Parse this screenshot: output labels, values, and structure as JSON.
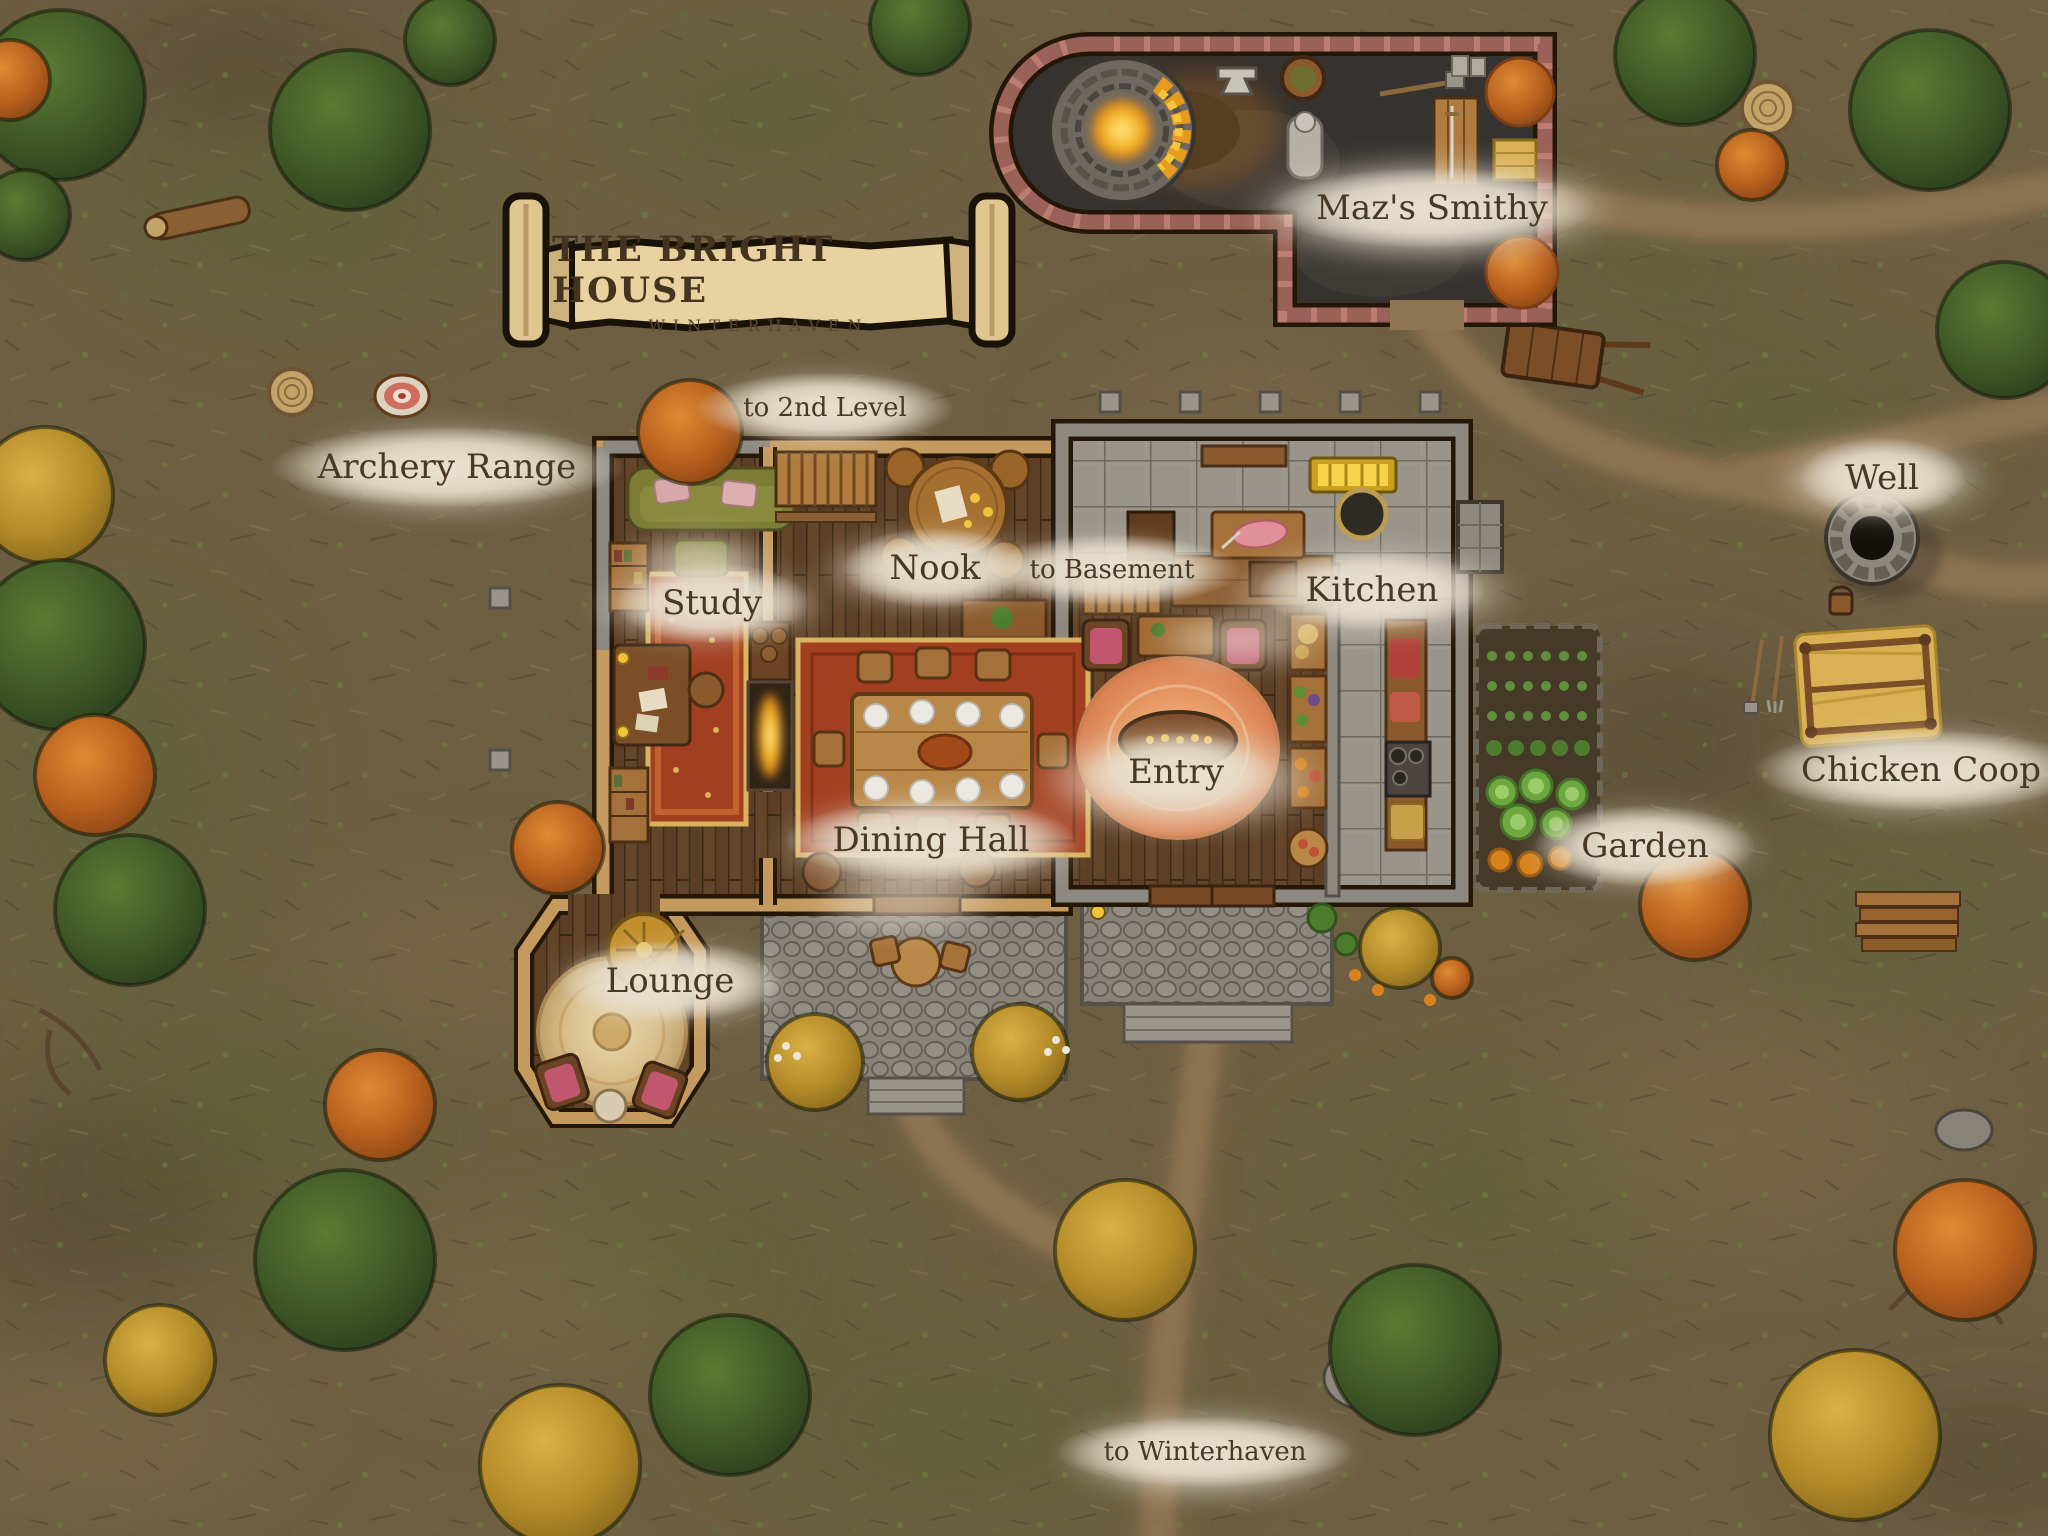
{
  "banner": {
    "title": "THE BRIGHT HOUSE",
    "subtitle": "WINTERHAVEN"
  },
  "labels": {
    "smithy": "Maz's Smithy",
    "archery_range": "Archery Range",
    "well": "Well",
    "to_2nd_level": "to 2nd Level",
    "nook": "Nook",
    "to_basement": "to Basement",
    "kitchen": "Kitchen",
    "study": "Study",
    "entry": "Entry",
    "dining_hall": "Dining Hall",
    "lounge": "Lounge",
    "garden": "Garden",
    "chicken_coop": "Chicken Coop",
    "to_winterhaven": "to Winterhaven"
  },
  "palette": {
    "parchment": "#e7d2a0",
    "ink": "#483826",
    "mist": "#e8e0cf",
    "ground": "#6e5f43",
    "path": "#907454",
    "wood_floor": "#5b3e25",
    "wall_wood": "#c59a5e",
    "stone": "#9a948a",
    "brick": "#bb7d72",
    "forge_glow": "#f7c032",
    "tree_green": "#3f5826",
    "tree_orange": "#b75f1e",
    "tree_gold": "#b38a28"
  }
}
